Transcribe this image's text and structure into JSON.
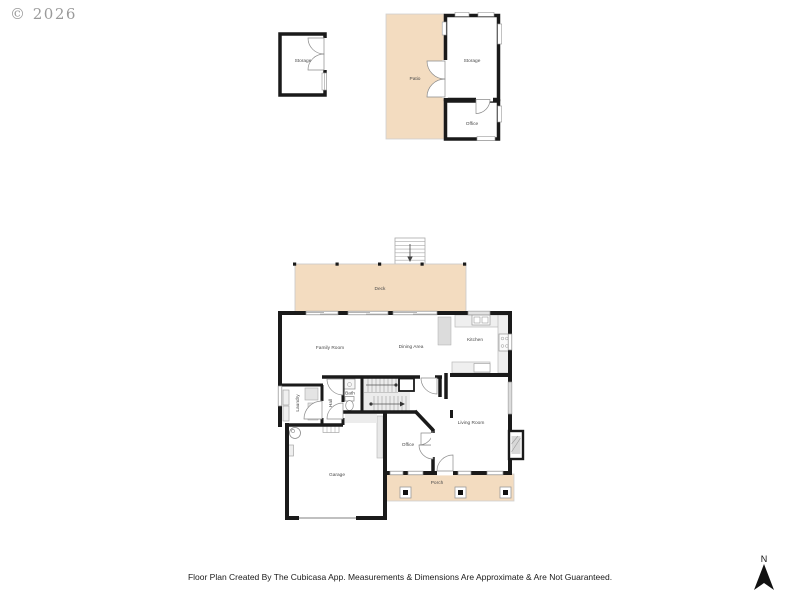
{
  "watermark": "© 2026",
  "disclaimer": "Floor Plan Created By The Cubicasa App. Measurements & Dimensions Are Approximate & Are Not Guaranteed.",
  "compass": {
    "label": "N"
  },
  "colors": {
    "wall": "#1a1a1a",
    "outdoor_fill": "#f3dcc0",
    "fixture_fill": "#efefef",
    "fixture_stroke": "#9a9a9a",
    "label": "#4a4a4a",
    "hatch": "#d8d8d8"
  },
  "rooms": {
    "shed_storage": "Storage",
    "patio": "Patio",
    "upper_storage": "Storage",
    "upper_office": "Office",
    "deck": "Deck",
    "family_room": "Family Room",
    "dining_area": "Dining Area",
    "kitchen": "Kitchen",
    "laundry": "Laundry",
    "hall": "Hall",
    "bath": "Bath",
    "living_room": "Living Room",
    "office": "Office",
    "garage": "Garage",
    "porch": "Porch"
  }
}
